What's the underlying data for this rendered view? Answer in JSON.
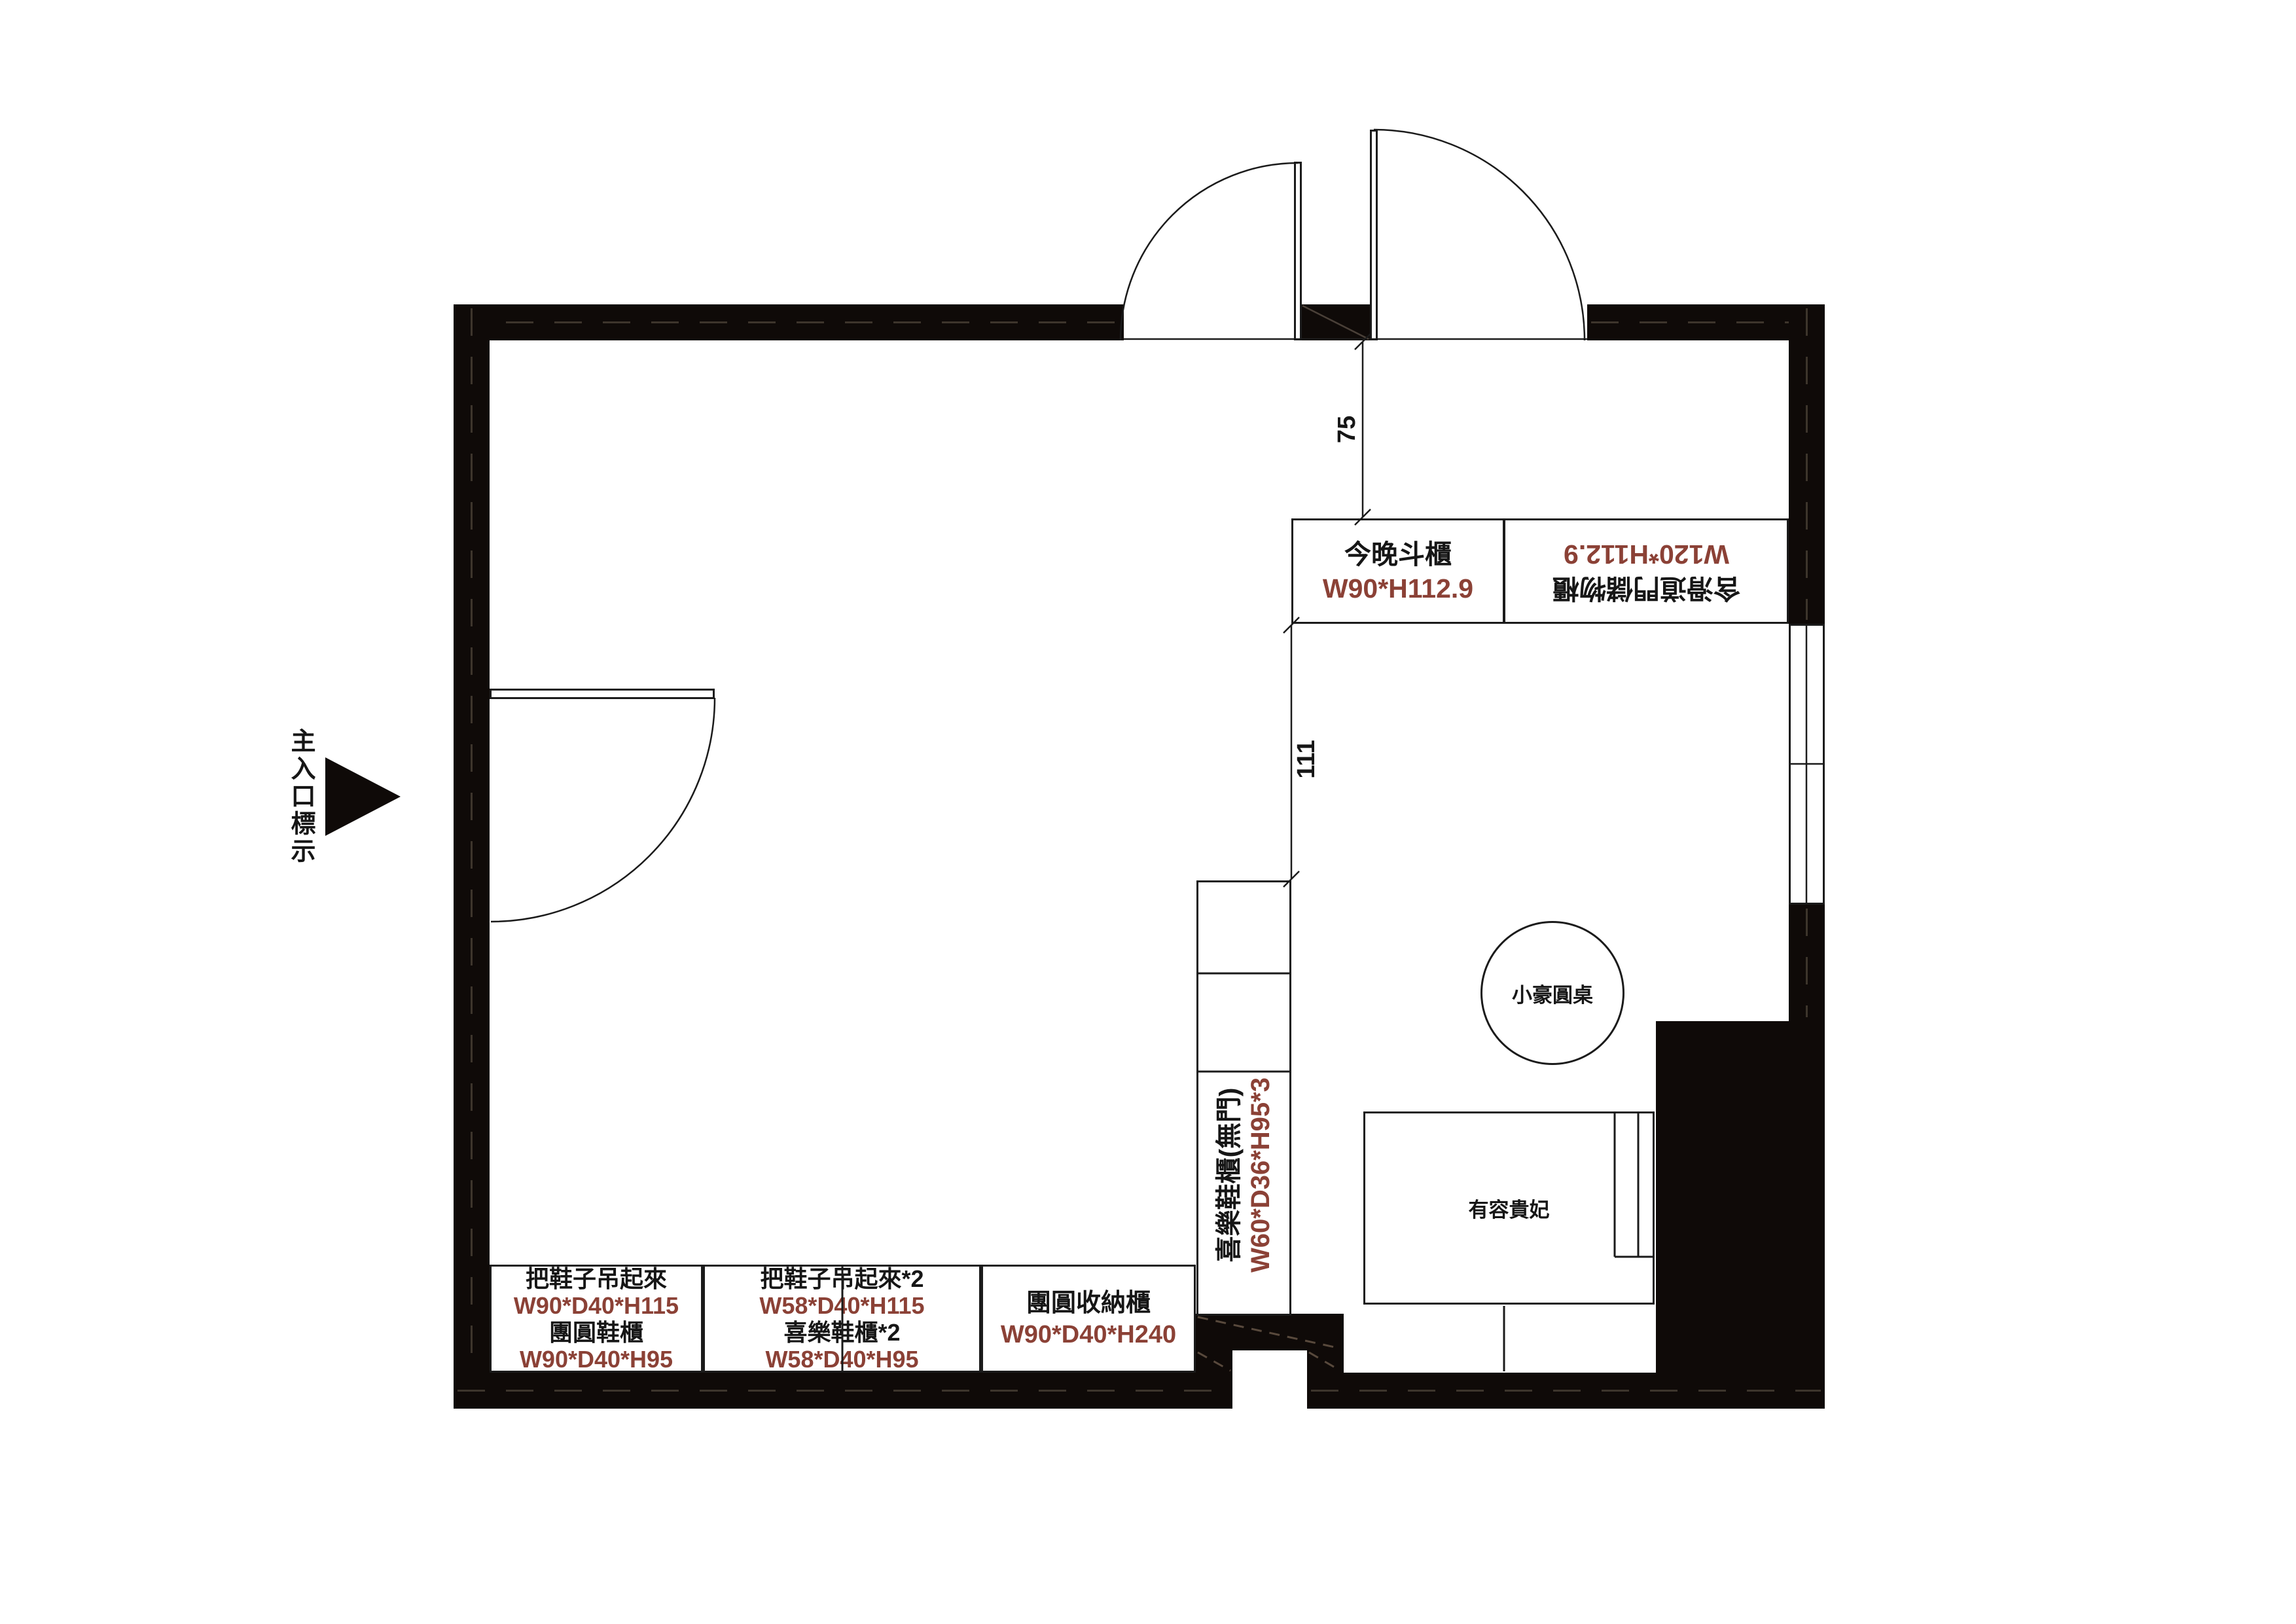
{
  "colors": {
    "wall": "#0F0A08",
    "ink": "#161616",
    "dim": "#8B4136"
  },
  "entrance": {
    "label": "主入口標示"
  },
  "dims": {
    "door_offset": "75",
    "column_gap": "111"
  },
  "cabinets": {
    "top_left": {
      "name": "今晚斗櫃",
      "size": "W90*H112.9"
    },
    "top_right": {
      "name": "含滑道門儲物櫃",
      "size": "W120*H112.9"
    },
    "column": {
      "name": "喜樂鞋櫃(無門)",
      "size": "W60*D36*H95*3"
    },
    "bottom_1": {
      "line1": "把鞋子吊起來",
      "line2": "W90*D40*H115",
      "line3": "團圓鞋櫃",
      "line4": "W90*D40*H95"
    },
    "bottom_2": {
      "line1": "把鞋子吊起來*2",
      "line2": "W58*D40*H115",
      "line3": "喜樂鞋櫃*2",
      "line4": "W58*D40*H95"
    },
    "bottom_3": {
      "name": "團圓收納櫃",
      "size": "W90*D40*H240"
    }
  },
  "furniture": {
    "round_table": "小豪圓桌",
    "chaise": "有容貴妃"
  }
}
